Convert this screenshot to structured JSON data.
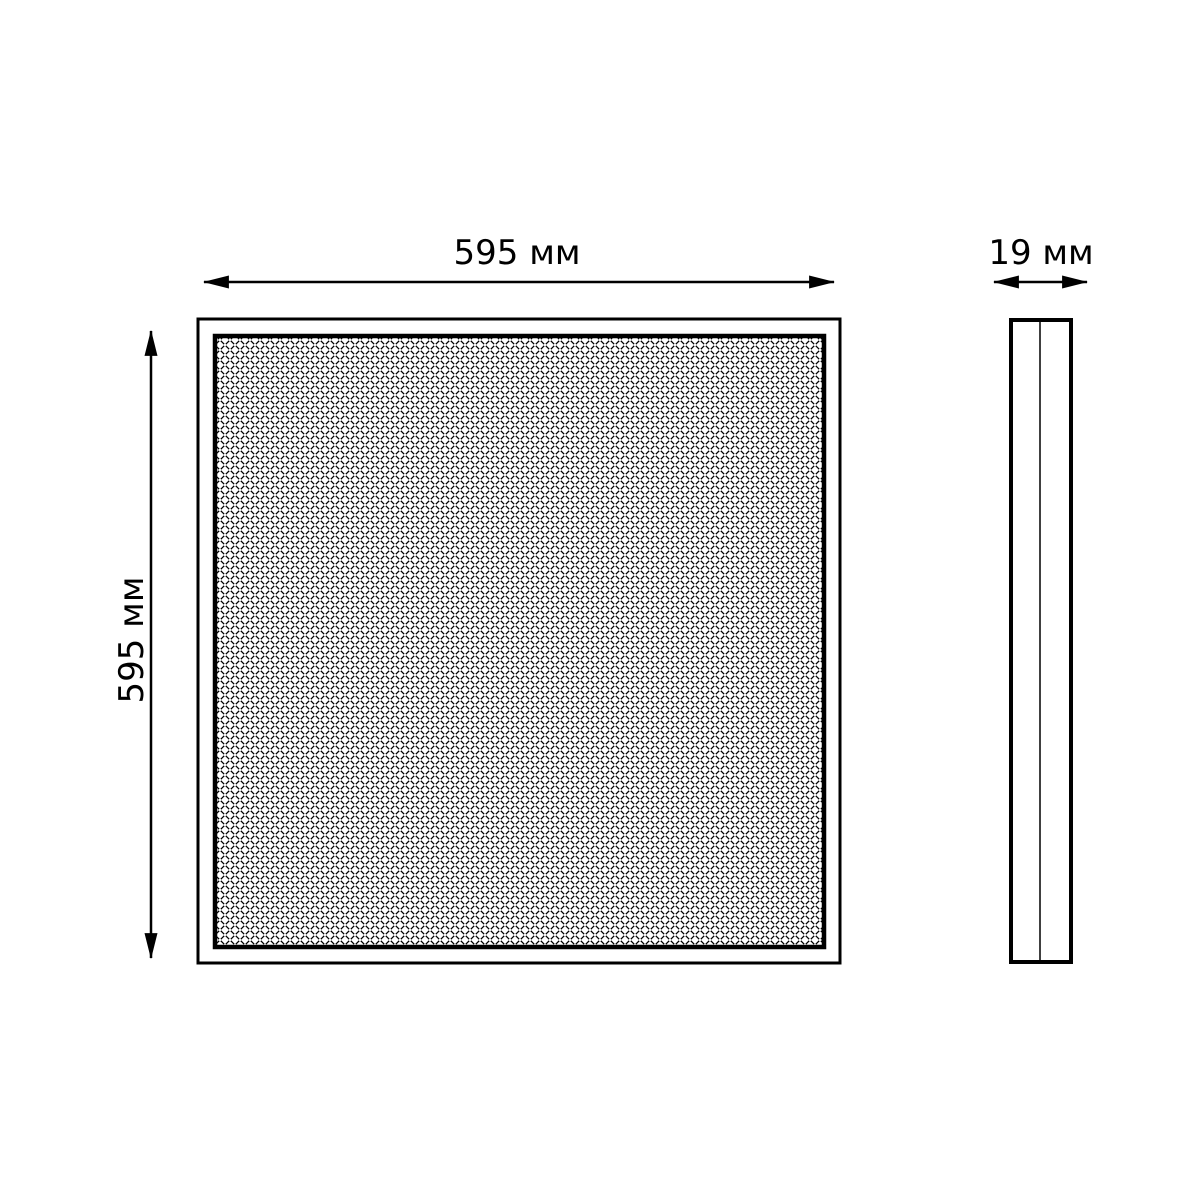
{
  "front_view": {
    "width_label": "595 мм",
    "height_label": "595 мм"
  },
  "side_view": {
    "depth_label": "19 мм"
  },
  "colors": {
    "line": "#000000",
    "background": "#ffffff"
  }
}
